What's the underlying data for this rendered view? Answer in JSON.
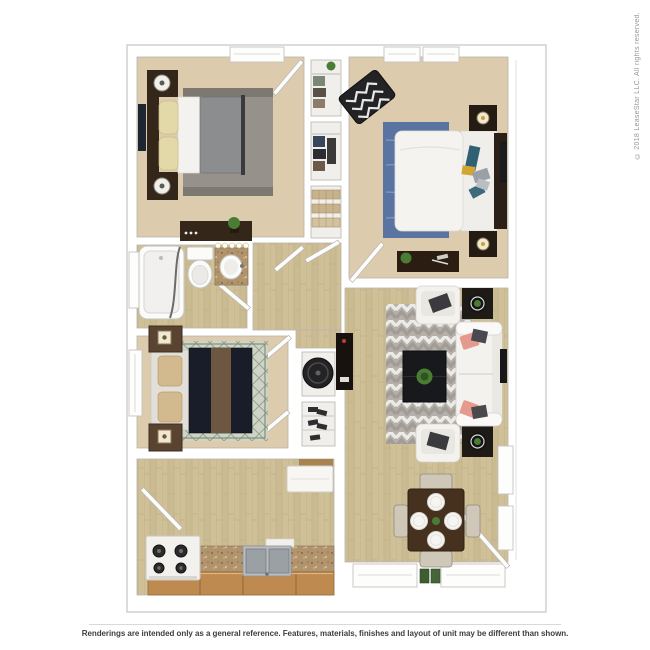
{
  "copyright": "© 2018 LeaseStar LLC. All rights reserved.",
  "footer": {
    "disclaimer": "Renderings are intended only as a general reference. Features, materials, finishes and layout of unit may be different than shown."
  },
  "floor_plan": {
    "type": "3d-rendered-apartment-floor-plan",
    "rooms": [
      {
        "name": "bedroom-top-left",
        "furniture": [
          "bed with gray duvet and yellow pillows",
          "two dark nightstands with round lamps",
          "dresser with plant",
          "wall tv",
          "gray rug",
          "closet with hanging clothes"
        ]
      },
      {
        "name": "bedroom-top-right",
        "furniture": [
          "bed with white duvet",
          "dark headboard with blue, gray and yellow pillows",
          "two nightstands with lamps",
          "black-and-white chevron accent chair",
          "blue rug",
          "desk with plant",
          "wall tv"
        ]
      },
      {
        "name": "bedroom-middle-left",
        "furniture": [
          "bed with navy duvet and brown runner",
          "upholstered headboard with tan pillows",
          "two wood nightstands with lamps",
          "diamond-pattern sage rug"
        ]
      },
      {
        "name": "bathroom",
        "furniture": [
          "bathtub with shower curtain",
          "toilet",
          "granite vanity with round sink and mirror lights"
        ]
      },
      {
        "name": "hallway",
        "furniture": [
          "linen closet with baskets",
          "utility closet with water heater",
          "shoe shelf closet"
        ]
      },
      {
        "name": "living-room",
        "furniture": [
          "white sofa with pink and striped pillows",
          "two white armchairs with dark pillows",
          "dark coffee table with green plant",
          "two plant side tables",
          "geometric chevron rug",
          "media console",
          "wall tv"
        ]
      },
      {
        "name": "kitchen",
        "furniture": [
          "white range with four burners",
          "double stainless sink",
          "granite counter",
          "wood base cabinets",
          "white wall cabinet"
        ]
      },
      {
        "name": "dining-area",
        "furniture": [
          "dark wood table with four place settings",
          "four chairs",
          "entry door",
          "two windows with green door mats"
        ]
      }
    ]
  },
  "palette": {
    "wall": "#ffffff",
    "plan-outline": "#c7c5c0",
    "wall-line": "#b9b5ae",
    "carpet": "#dccbad",
    "wood-base": "#cfc098",
    "wood-alt": "#c6b58c",
    "wood-grain": "#b8a67d",
    "closet-floor": "#f0efeb",
    "dark-wood": "#342619",
    "navy": "#14161f",
    "rug-gray": "#96918a",
    "rug-blue": "#5a74a1",
    "rug-sage-base": "#ced4c6",
    "rug-sage-line": "#93a08e",
    "chev-base": "#b5b0a9",
    "chev-light": "#edebe7",
    "chev-dark": "#a19c95",
    "granite": "#b1946c",
    "cabinet-wood": "#c08a52",
    "sofa-white": "#f4f2ee",
    "pink": "#e59a8e",
    "green": "#4b7c33",
    "yellow": "#d9b23f",
    "steel": "#9aa0a4",
    "text-gray": "#979797",
    "text-dark": "#3e3e3e",
    "divider": "#d9d9d9"
  }
}
